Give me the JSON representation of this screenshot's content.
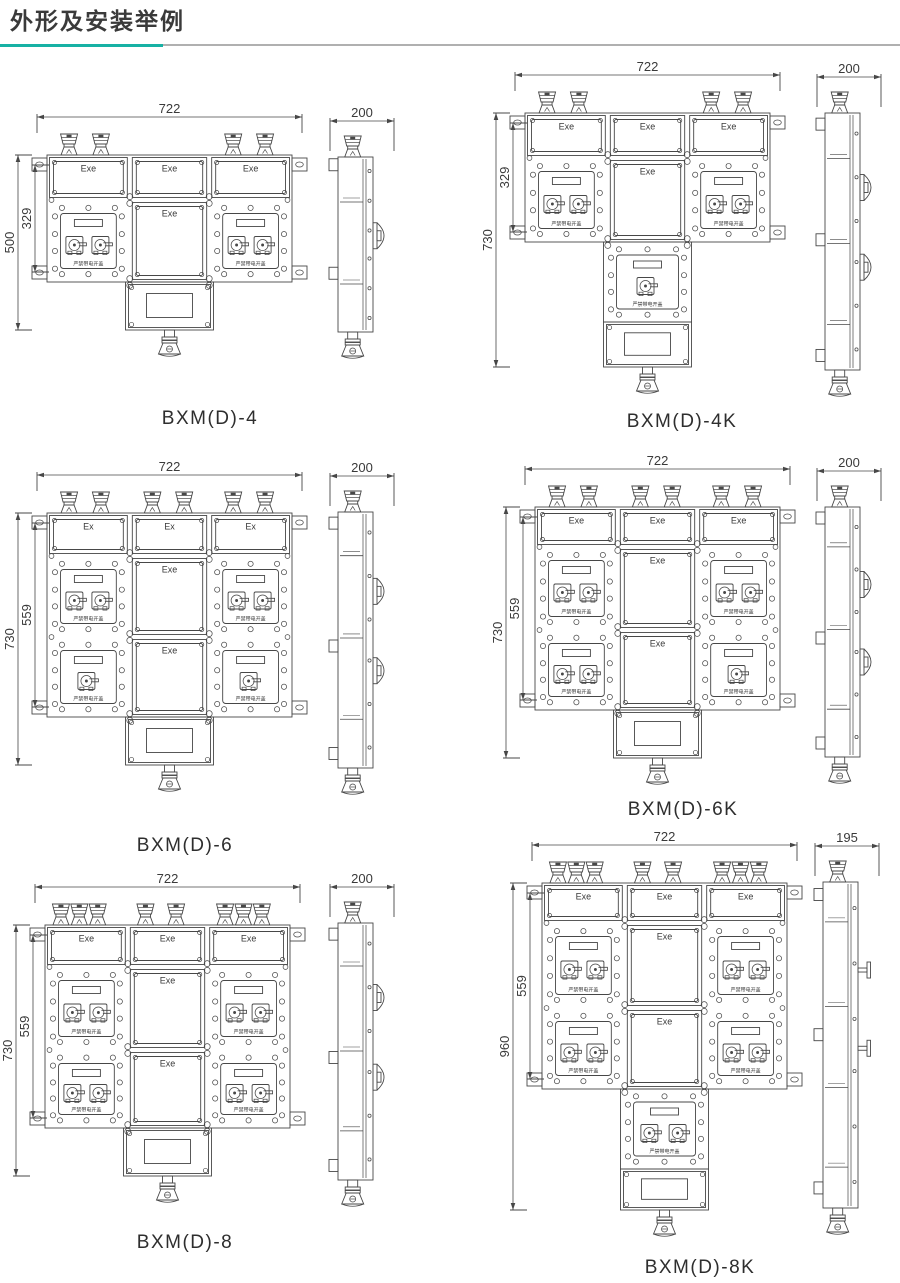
{
  "page": {
    "title": "外形及安装举例",
    "accent_color": "#17b1a4",
    "rule_color": "#b0b0b0",
    "ink_color": "#474747"
  },
  "shared_labels": {
    "cover_warning": "严禁带电开盖"
  },
  "diagrams": [
    {
      "model": "BXM(D)-4",
      "front_view": {
        "width_dim": "722",
        "overall_height_dim": "500",
        "mounting_height_dim": "329",
        "cable_glands_top": 4,
        "top_box_labels": [
          "Exe",
          "Exe",
          "Exe"
        ],
        "rows": [
          {
            "left_panel_switches": 2,
            "center_box_label": "Exe",
            "right_panel_switches": 2
          }
        ],
        "lower_control_panel_switches": 0,
        "has_window_box": true
      },
      "side_view": {
        "depth_dim": "200"
      }
    },
    {
      "model": "BXM(D)-4K",
      "front_view": {
        "width_dim": "722",
        "overall_height_dim": "730",
        "mounting_height_dim": "329",
        "cable_glands_top": 4,
        "top_box_labels": [
          "Exe",
          "Exe",
          "Exe"
        ],
        "rows": [
          {
            "left_panel_switches": 2,
            "center_box_label": "Exe",
            "right_panel_switches": 2
          }
        ],
        "lower_control_panel_switches": 1,
        "has_window_box": true
      },
      "side_view": {
        "depth_dim": "200"
      }
    },
    {
      "model": "BXM(D)-6",
      "front_view": {
        "width_dim": "722",
        "overall_height_dim": "730",
        "mounting_height_dim": "559",
        "cable_glands_top": 6,
        "top_box_labels": [
          "Ex",
          "Ex",
          "Ex"
        ],
        "rows": [
          {
            "left_panel_switches": 2,
            "center_box_label": "Exe",
            "right_panel_switches": 2
          },
          {
            "left_panel_switches": 1,
            "center_box_label": "Exe",
            "right_panel_switches": 1
          }
        ],
        "lower_control_panel_switches": 0,
        "has_window_box": true
      },
      "side_view": {
        "depth_dim": "200"
      }
    },
    {
      "model": "BXM(D)-6K",
      "front_view": {
        "width_dim": "722",
        "overall_height_dim": "730",
        "mounting_height_dim": "559",
        "cable_glands_top": 6,
        "top_box_labels": [
          "Exe",
          "Exe",
          "Exe"
        ],
        "rows": [
          {
            "left_panel_switches": 2,
            "center_box_label": "Exe",
            "right_panel_switches": 2
          },
          {
            "left_panel_switches": 2,
            "center_box_label": "Exe",
            "right_panel_switches": 1
          }
        ],
        "lower_control_panel_switches": 0,
        "has_window_box": true
      },
      "side_view": {
        "depth_dim": "200"
      }
    },
    {
      "model": "BXM(D)-8",
      "front_view": {
        "width_dim": "722",
        "overall_height_dim": "730",
        "mounting_height_dim": "559",
        "cable_glands_top": 8,
        "top_box_labels": [
          "Exe",
          "Exe",
          "Exe"
        ],
        "rows": [
          {
            "left_panel_switches": 2,
            "center_box_label": "Exe",
            "right_panel_switches": 2
          },
          {
            "left_panel_switches": 2,
            "center_box_label": "Exe",
            "right_panel_switches": 2
          }
        ],
        "lower_control_panel_switches": 0,
        "has_window_box": true
      },
      "side_view": {
        "depth_dim": "200"
      }
    },
    {
      "model": "BXM(D)-8K",
      "front_view": {
        "width_dim": "722",
        "overall_height_dim": "960",
        "mounting_height_dim": "559",
        "cable_glands_top": 8,
        "top_box_labels": [
          "Exe",
          "Exe",
          "Exe"
        ],
        "rows": [
          {
            "left_panel_switches": 2,
            "center_box_label": "Exe",
            "right_panel_switches": 2
          },
          {
            "left_panel_switches": 2,
            "center_box_label": "Exe",
            "right_panel_switches": 2
          }
        ],
        "lower_control_panel_switches": 2,
        "has_window_box": true
      },
      "side_view": {
        "depth_dim": "195"
      }
    }
  ]
}
